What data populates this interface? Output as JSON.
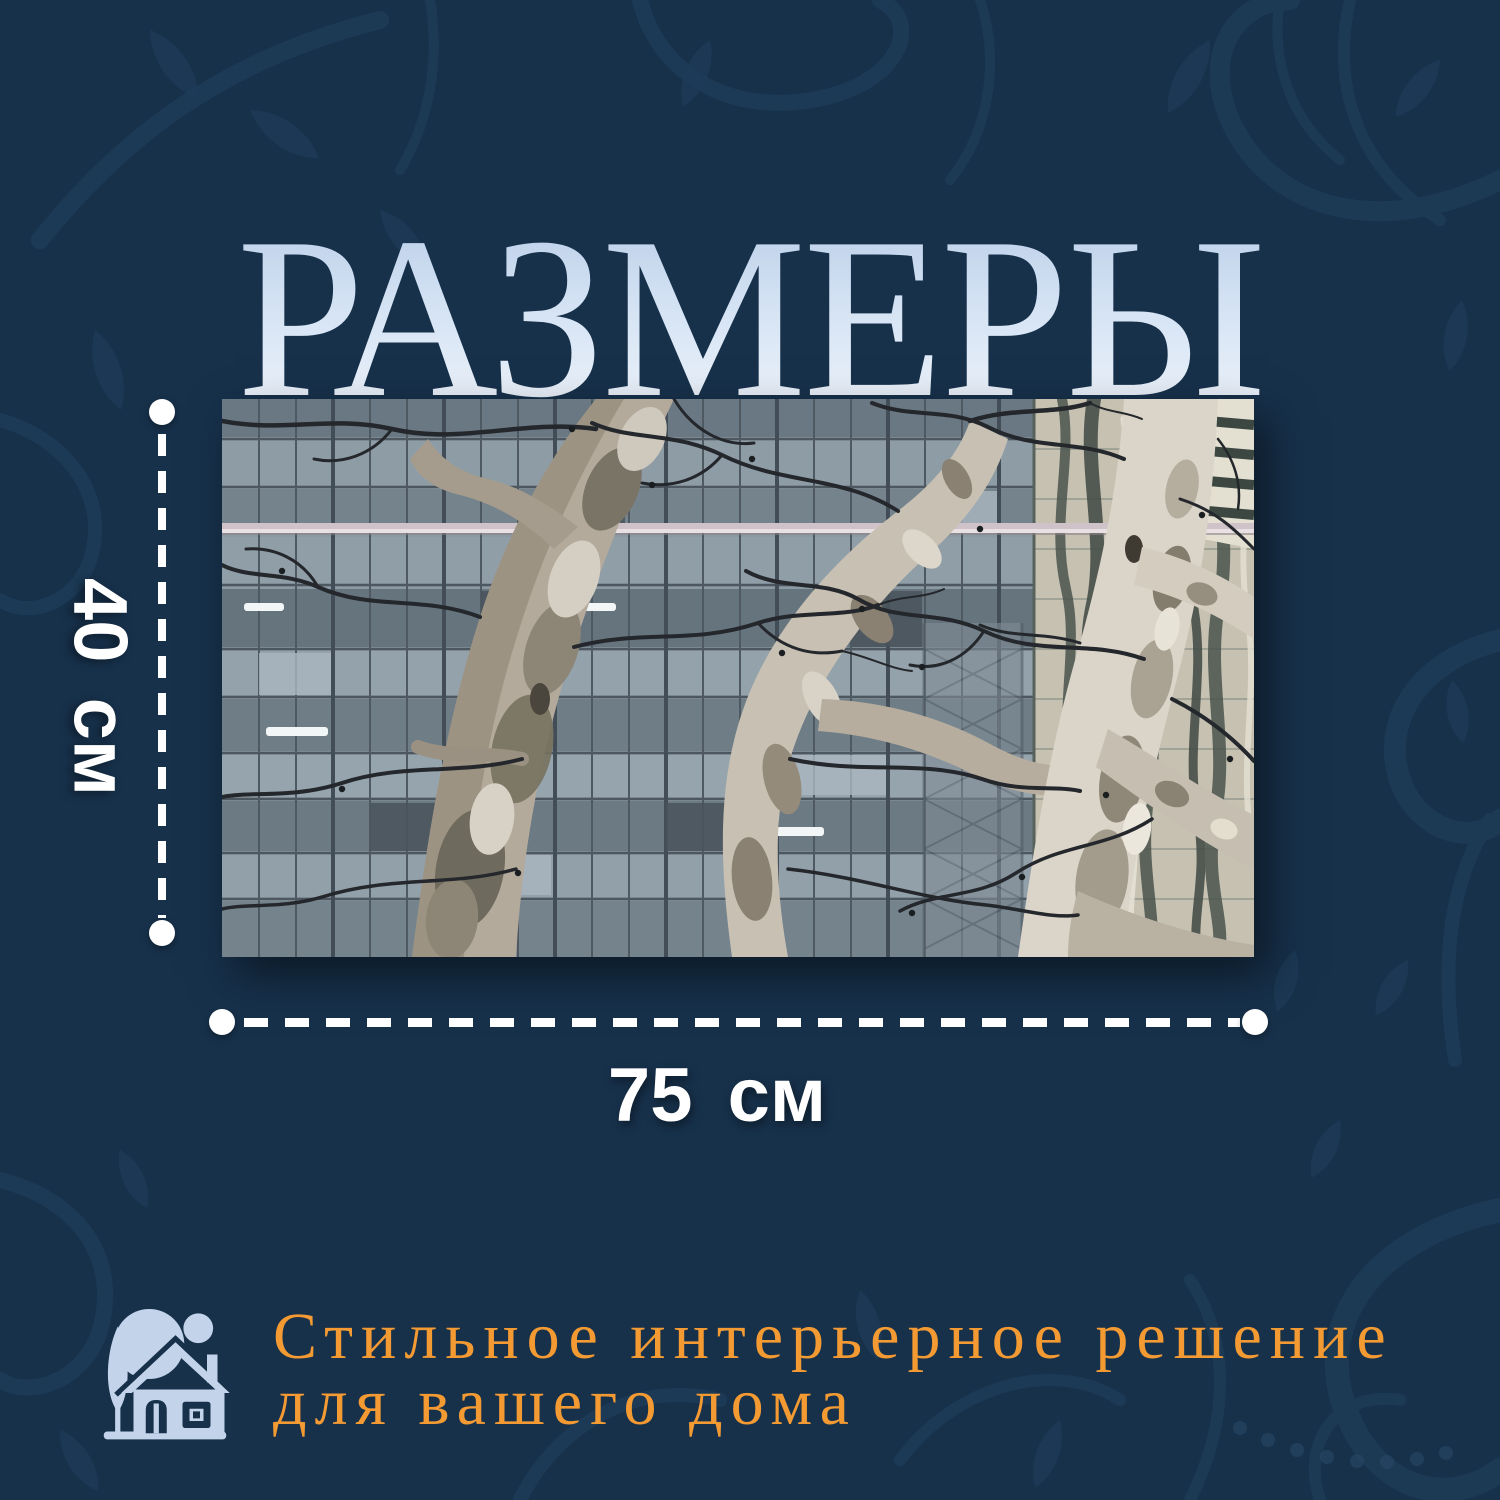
{
  "title": "РАЗМЕРЫ",
  "dimensions": {
    "height": "40 см",
    "width": "75 см"
  },
  "tagline": {
    "line1": "Стильное интерьерное решение",
    "line2": "для вашего дома"
  },
  "artwork": {
    "description": "Bare sycamore tree trunks and branches in front of a glass office building facade with a striped reflective tower on the right"
  },
  "colors": {
    "background_navy": "#17314B",
    "pattern_blue": "#1F3D59",
    "title_gradient_top": "#A9C0DE",
    "title_gradient_bottom": "#F2F7FD",
    "dimension_white": "#FFFFFF",
    "accent_orange": "#F49A33",
    "icon_light_blue": "#C2D3EA",
    "facade_grey": "#8B99A3",
    "right_building_cream": "#C6C1B1",
    "trunk_light": "#DBD5C9",
    "branch_dark": "#24272B"
  }
}
